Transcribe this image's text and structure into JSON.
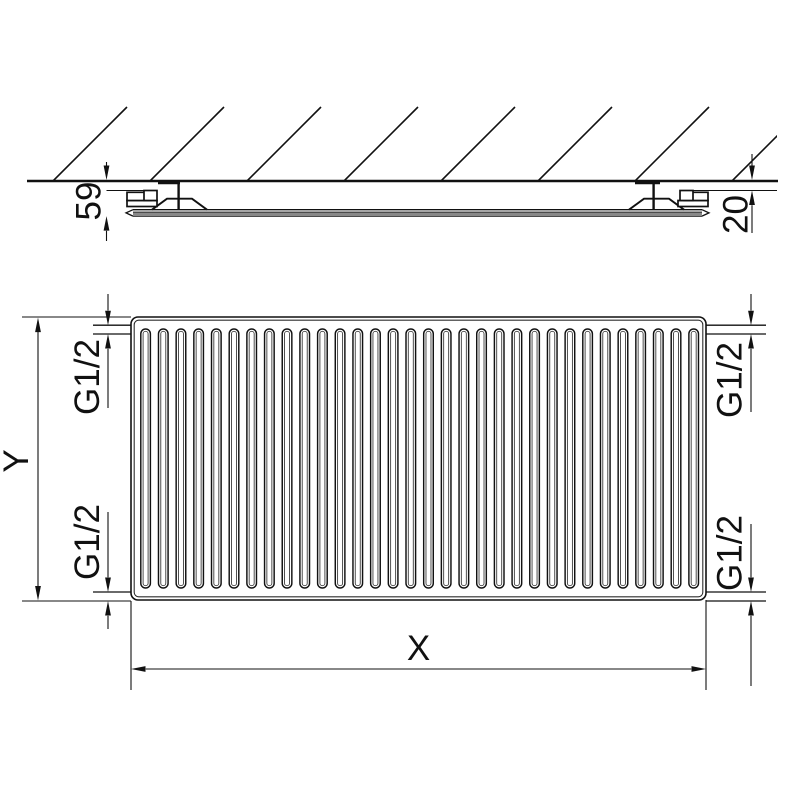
{
  "colors": {
    "line": "#111111",
    "background": "#ffffff"
  },
  "side_view": {
    "depth_dimension": "59",
    "wall_gap_dimension": "20"
  },
  "front_view": {
    "height_dimension": "Y",
    "width_dimension": "X",
    "connection_top_left": "G1/2",
    "connection_top_right": "G1/2",
    "connection_bottom_left": "G1/2",
    "connection_bottom_right": "G1/2",
    "fin_count": 32
  }
}
